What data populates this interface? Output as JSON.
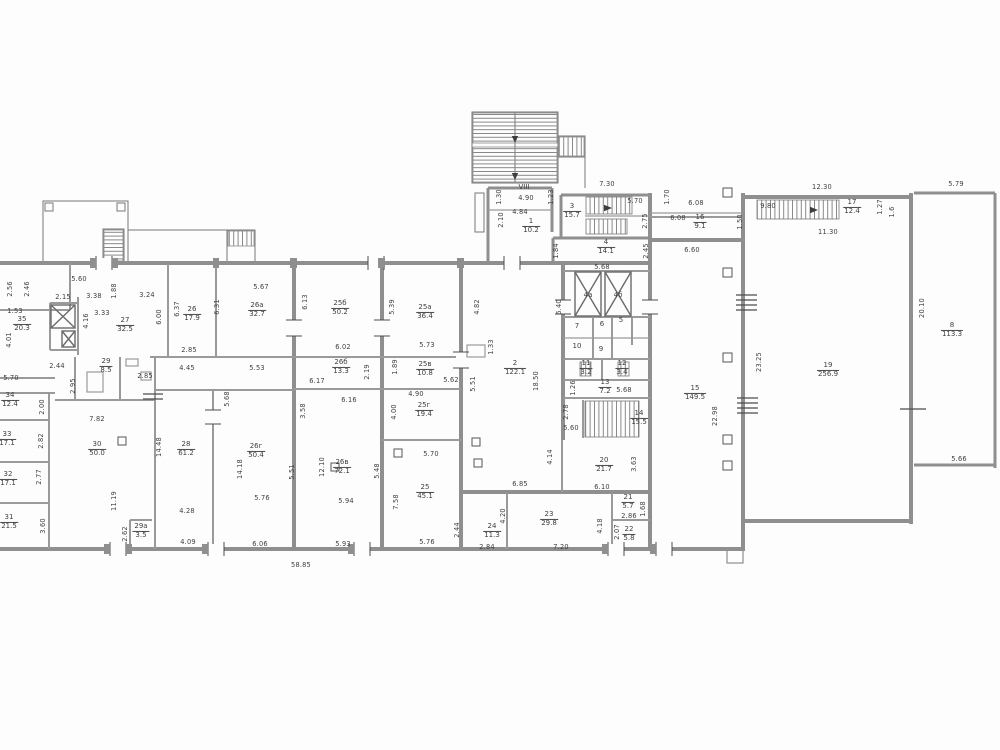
{
  "drawing": {
    "type": "architectural-floor-plan",
    "colors": {
      "background": "#fdfdfd",
      "wall": "#8f8f8f",
      "line": "#787878",
      "text": "#3e3e3e",
      "tick": "#4d4d4d"
    },
    "bottom_total_dimension": "58.85",
    "rooms": [
      {
        "no": "1",
        "area": "10.2",
        "x": 531,
        "y": 226
      },
      {
        "no": "2",
        "area": "122.1",
        "x": 515,
        "y": 368
      },
      {
        "no": "3",
        "area": "15.7",
        "x": 572,
        "y": 211
      },
      {
        "no": "4",
        "area": "14.1",
        "x": 606,
        "y": 247
      },
      {
        "no": "8",
        "area": "113.3",
        "x": 952,
        "y": 330
      },
      {
        "no": "11",
        "area": "3.2",
        "x": 586,
        "y": 368
      },
      {
        "no": "12",
        "area": "3.4",
        "x": 622,
        "y": 368
      },
      {
        "no": "13",
        "area": "7.2",
        "x": 605,
        "y": 387
      },
      {
        "no": "14",
        "area": "15.5",
        "x": 639,
        "y": 418
      },
      {
        "no": "15",
        "area": "149.5",
        "x": 695,
        "y": 393
      },
      {
        "no": "16",
        "area": "9.1",
        "x": 700,
        "y": 222
      },
      {
        "no": "17",
        "area": "12.4",
        "x": 852,
        "y": 207
      },
      {
        "no": "19",
        "area": "256.9",
        "x": 828,
        "y": 370
      },
      {
        "no": "20",
        "area": "21.7",
        "x": 604,
        "y": 465
      },
      {
        "no": "21",
        "area": "5.7",
        "x": 628,
        "y": 502
      },
      {
        "no": "22",
        "area": "5.8",
        "x": 629,
        "y": 534
      },
      {
        "no": "23",
        "area": "29.8",
        "x": 549,
        "y": 519
      },
      {
        "no": "24",
        "area": "11.3",
        "x": 492,
        "y": 531
      },
      {
        "no": "25",
        "area": "45.1",
        "x": 425,
        "y": 492
      },
      {
        "no": "25а",
        "area": "36.4",
        "x": 425,
        "y": 312
      },
      {
        "no": "25б",
        "area": "50.2",
        "x": 340,
        "y": 308
      },
      {
        "no": "25в",
        "area": "10.8",
        "x": 425,
        "y": 369
      },
      {
        "no": "25г",
        "area": "19.4",
        "x": 424,
        "y": 410
      },
      {
        "no": "26",
        "area": "17.9",
        "x": 192,
        "y": 314
      },
      {
        "no": "26а",
        "area": "32.7",
        "x": 257,
        "y": 310
      },
      {
        "no": "26б",
        "area": "13.3",
        "x": 341,
        "y": 367
      },
      {
        "no": "26в",
        "area": "72.1",
        "x": 342,
        "y": 467
      },
      {
        "no": "26г",
        "area": "50.4",
        "x": 256,
        "y": 451
      },
      {
        "no": "27",
        "area": "32.5",
        "x": 125,
        "y": 325
      },
      {
        "no": "28",
        "area": "61.2",
        "x": 186,
        "y": 449
      },
      {
        "no": "29",
        "area": "8.5",
        "x": 106,
        "y": 366
      },
      {
        "no": "29а",
        "area": "3.5",
        "x": 141,
        "y": 531
      },
      {
        "no": "30",
        "area": "50.0",
        "x": 97,
        "y": 449
      },
      {
        "no": "31",
        "area": "21.5",
        "x": 9,
        "y": 522
      },
      {
        "no": "32",
        "area": "17.1",
        "x": 8,
        "y": 479
      },
      {
        "no": "33",
        "area": "17.1",
        "x": 7,
        "y": 439
      },
      {
        "no": "34",
        "area": "12.4",
        "x": 10,
        "y": 400
      },
      {
        "no": "35",
        "area": "20.3",
        "x": 22,
        "y": 324
      }
    ],
    "labels": [
      {
        "t": "VIII",
        "x": 524,
        "y": 187
      },
      {
        "t": "4а",
        "x": 588,
        "y": 295
      },
      {
        "t": "4б",
        "x": 618,
        "y": 295
      },
      {
        "t": "7",
        "x": 577,
        "y": 326
      },
      {
        "t": "6",
        "x": 602,
        "y": 324
      },
      {
        "t": "5",
        "x": 621,
        "y": 320
      },
      {
        "t": "10",
        "x": 577,
        "y": 346
      },
      {
        "t": "9",
        "x": 601,
        "y": 349
      }
    ],
    "dims": [
      {
        "t": "2.56",
        "x": 10,
        "y": 289,
        "v": 1
      },
      {
        "t": "2.46",
        "x": 27,
        "y": 289,
        "v": 1
      },
      {
        "t": "1.53",
        "x": 15,
        "y": 311
      },
      {
        "t": "4.01",
        "x": 9,
        "y": 340,
        "v": 1
      },
      {
        "t": "5.70",
        "x": 11,
        "y": 378
      },
      {
        "t": "2.15",
        "x": 63,
        "y": 297
      },
      {
        "t": "3.38",
        "x": 94,
        "y": 296
      },
      {
        "t": "1.88",
        "x": 114,
        "y": 291,
        "v": 1
      },
      {
        "t": "3.33",
        "x": 102,
        "y": 313
      },
      {
        "t": "4.16",
        "x": 86,
        "y": 321,
        "v": 1
      },
      {
        "t": "2.44",
        "x": 57,
        "y": 366
      },
      {
        "t": "2.95",
        "x": 73,
        "y": 386,
        "v": 1
      },
      {
        "t": "5.60",
        "x": 79,
        "y": 279
      },
      {
        "t": "3.24",
        "x": 147,
        "y": 295
      },
      {
        "t": "6.00",
        "x": 159,
        "y": 317,
        "v": 1
      },
      {
        "t": "2.85",
        "x": 145,
        "y": 376
      },
      {
        "t": "6.37",
        "x": 177,
        "y": 309,
        "v": 1
      },
      {
        "t": "2.85",
        "x": 189,
        "y": 350
      },
      {
        "t": "4.45",
        "x": 187,
        "y": 368
      },
      {
        "t": "5.68",
        "x": 227,
        "y": 399,
        "v": 1
      },
      {
        "t": "6.31",
        "x": 217,
        "y": 307,
        "v": 1
      },
      {
        "t": "5.67",
        "x": 261,
        "y": 287
      },
      {
        "t": "6.13",
        "x": 305,
        "y": 302,
        "v": 1
      },
      {
        "t": "5.39",
        "x": 392,
        "y": 307,
        "v": 1
      },
      {
        "t": "4.82",
        "x": 477,
        "y": 307,
        "v": 1
      },
      {
        "t": "5.53",
        "x": 257,
        "y": 368
      },
      {
        "t": "6.02",
        "x": 343,
        "y": 347
      },
      {
        "t": "5.73",
        "x": 427,
        "y": 345
      },
      {
        "t": "6.17",
        "x": 317,
        "y": 381
      },
      {
        "t": "2.19",
        "x": 367,
        "y": 372,
        "v": 1
      },
      {
        "t": "1.89",
        "x": 395,
        "y": 367,
        "v": 1
      },
      {
        "t": "6.16",
        "x": 349,
        "y": 400
      },
      {
        "t": "3.58",
        "x": 303,
        "y": 411,
        "v": 1
      },
      {
        "t": "4.90",
        "x": 416,
        "y": 394
      },
      {
        "t": "4.00",
        "x": 394,
        "y": 412,
        "v": 1
      },
      {
        "t": "5.62",
        "x": 451,
        "y": 380
      },
      {
        "t": "5.51",
        "x": 473,
        "y": 384,
        "v": 1
      },
      {
        "t": "1.33",
        "x": 491,
        "y": 347,
        "v": 1
      },
      {
        "t": "18.50",
        "x": 536,
        "y": 381,
        "v": 1
      },
      {
        "t": "7.82",
        "x": 97,
        "y": 419
      },
      {
        "t": "2.00",
        "x": 42,
        "y": 407,
        "v": 1
      },
      {
        "t": "2.82",
        "x": 41,
        "y": 441,
        "v": 1
      },
      {
        "t": "2.77",
        "x": 39,
        "y": 477,
        "v": 1
      },
      {
        "t": "3.60",
        "x": 43,
        "y": 526,
        "v": 1
      },
      {
        "t": "14.48",
        "x": 159,
        "y": 447,
        "v": 1
      },
      {
        "t": "11.19",
        "x": 114,
        "y": 501,
        "v": 1
      },
      {
        "t": "2.62",
        "x": 125,
        "y": 534,
        "v": 1
      },
      {
        "t": "4.28",
        "x": 187,
        "y": 511
      },
      {
        "t": "4.09",
        "x": 188,
        "y": 542
      },
      {
        "t": "14.18",
        "x": 240,
        "y": 469,
        "v": 1
      },
      {
        "t": "5.76",
        "x": 262,
        "y": 498
      },
      {
        "t": "6.06",
        "x": 260,
        "y": 544
      },
      {
        "t": "5.51",
        "x": 292,
        "y": 472,
        "v": 1
      },
      {
        "t": "12.10",
        "x": 322,
        "y": 467,
        "v": 1
      },
      {
        "t": "5.94",
        "x": 346,
        "y": 501
      },
      {
        "t": "5.93",
        "x": 343,
        "y": 544
      },
      {
        "t": "5.48",
        "x": 377,
        "y": 471,
        "v": 1
      },
      {
        "t": "7.58",
        "x": 396,
        "y": 502,
        "v": 1
      },
      {
        "t": "5.70",
        "x": 431,
        "y": 454
      },
      {
        "t": "5.76",
        "x": 427,
        "y": 542
      },
      {
        "t": "2.44",
        "x": 457,
        "y": 530,
        "v": 1
      },
      {
        "t": "4.20",
        "x": 503,
        "y": 516,
        "v": 1
      },
      {
        "t": "2.84",
        "x": 487,
        "y": 547
      },
      {
        "t": "7.20",
        "x": 561,
        "y": 547
      },
      {
        "t": "4.18",
        "x": 600,
        "y": 526,
        "v": 1
      },
      {
        "t": "6.85",
        "x": 520,
        "y": 484
      },
      {
        "t": "6.10",
        "x": 602,
        "y": 487
      },
      {
        "t": "4.14",
        "x": 550,
        "y": 457,
        "v": 1
      },
      {
        "t": "3.63",
        "x": 634,
        "y": 464,
        "v": 1
      },
      {
        "t": "2.86",
        "x": 629,
        "y": 516
      },
      {
        "t": "1.68",
        "x": 643,
        "y": 509,
        "v": 1
      },
      {
        "t": "2.07",
        "x": 617,
        "y": 532,
        "v": 1
      },
      {
        "t": "58.85",
        "x": 301,
        "y": 565
      },
      {
        "t": "1.30",
        "x": 499,
        "y": 197,
        "v": 1
      },
      {
        "t": "4.90",
        "x": 526,
        "y": 198
      },
      {
        "t": "1.23",
        "x": 551,
        "y": 197,
        "v": 1
      },
      {
        "t": "2.10",
        "x": 501,
        "y": 220,
        "v": 1
      },
      {
        "t": "4.84",
        "x": 520,
        "y": 212
      },
      {
        "t": "7.30",
        "x": 607,
        "y": 184
      },
      {
        "t": "5.70",
        "x": 635,
        "y": 201
      },
      {
        "t": "2.75",
        "x": 645,
        "y": 221,
        "v": 1
      },
      {
        "t": "1.70",
        "x": 667,
        "y": 197,
        "v": 1
      },
      {
        "t": "1.84",
        "x": 556,
        "y": 251,
        "v": 1
      },
      {
        "t": "2.45",
        "x": 646,
        "y": 251,
        "v": 1
      },
      {
        "t": "5.68",
        "x": 602,
        "y": 267
      },
      {
        "t": "6.40",
        "x": 559,
        "y": 307,
        "v": 1
      },
      {
        "t": "1.26",
        "x": 573,
        "y": 388,
        "v": 1
      },
      {
        "t": "5.68",
        "x": 624,
        "y": 390
      },
      {
        "t": "2.78",
        "x": 566,
        "y": 412,
        "v": 1
      },
      {
        "t": "5.60",
        "x": 571,
        "y": 428
      },
      {
        "t": "6.08",
        "x": 696,
        "y": 203
      },
      {
        "t": "6.08",
        "x": 678,
        "y": 218
      },
      {
        "t": "6.60",
        "x": 692,
        "y": 250
      },
      {
        "t": "1.50",
        "x": 740,
        "y": 222,
        "v": 1
      },
      {
        "t": "12.30",
        "x": 822,
        "y": 187
      },
      {
        "t": "9.80",
        "x": 768,
        "y": 206
      },
      {
        "t": "1.27",
        "x": 880,
        "y": 207,
        "v": 1
      },
      {
        "t": "1.6",
        "x": 892,
        "y": 212,
        "v": 1
      },
      {
        "t": "11.30",
        "x": 828,
        "y": 232
      },
      {
        "t": "5.79",
        "x": 956,
        "y": 184
      },
      {
        "t": "20.10",
        "x": 922,
        "y": 308,
        "v": 1
      },
      {
        "t": "23.25",
        "x": 759,
        "y": 362,
        "v": 1
      },
      {
        "t": "22.98",
        "x": 715,
        "y": 416,
        "v": 1
      },
      {
        "t": "5.66",
        "x": 959,
        "y": 459
      }
    ]
  }
}
